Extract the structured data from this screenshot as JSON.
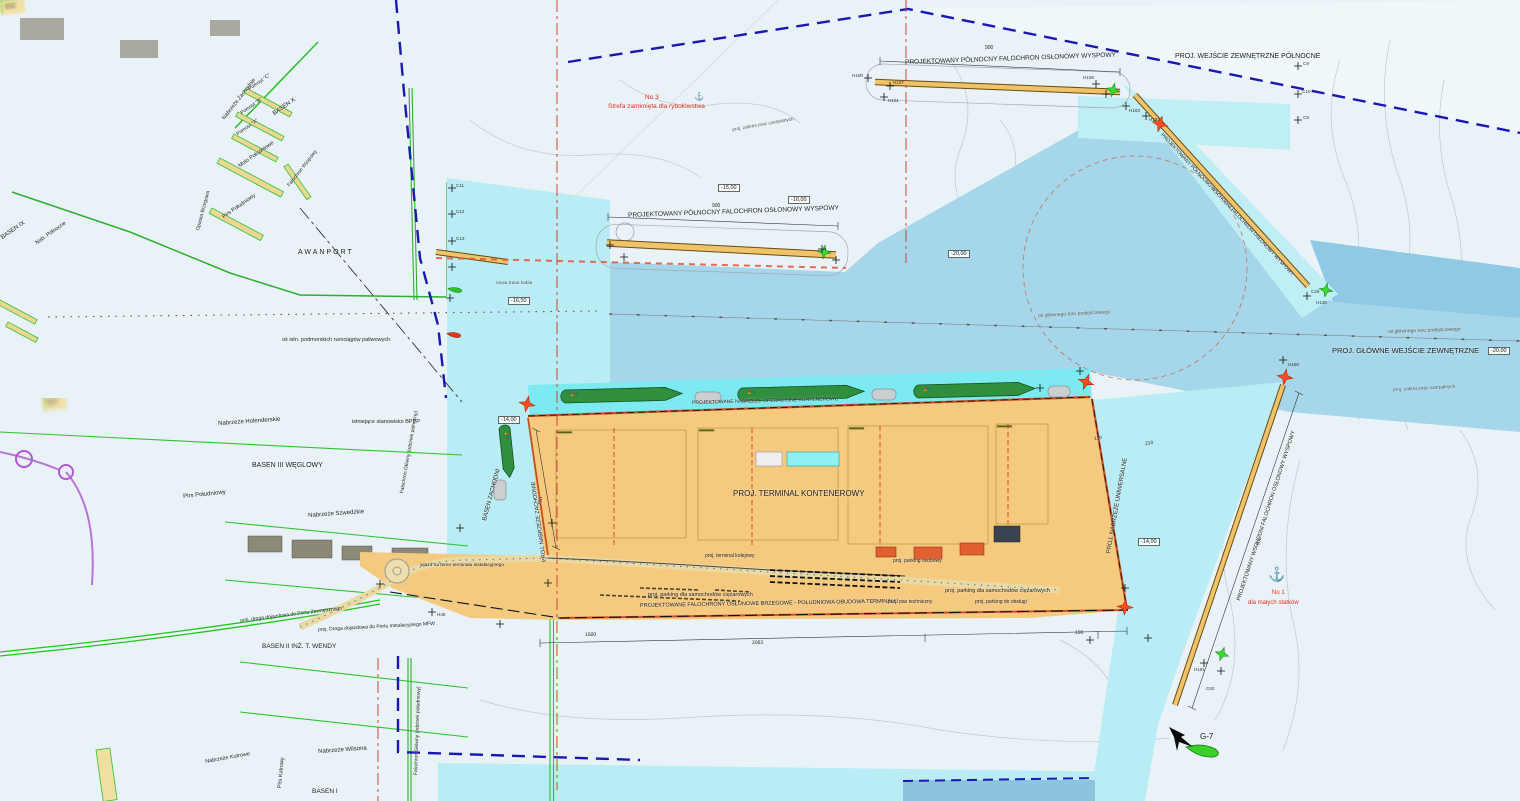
{
  "map": {
    "labels": {
      "entrance_north": "PROJ. WEJŚCIE ZEWNĘTRZNE PÓŁNOCNE",
      "entrance_main": "PROJ. GŁÓWNE WEJŚCIE ZEWNĘTRZNE",
      "bw_island_north": "PROJEKTOWANY PÓŁNOCNY FALOCHRON OSŁONOWY WYSPOWY",
      "bw_east": "PROJEKTOWANY WSCHODNI FALOCHRON OSŁONOWY WYSPOWY",
      "bw_northeast": "PROJEKTOWANY PÓŁNOCNO-WSCHODNI FALOCHRON OSŁONOWY WYSPOWY",
      "bw_shore_south": "PROJEKTOWANE FALOCHRONY OSŁONOWE BRZEGOWE - POŁUDNIOWA OBUDOWA TERMINALU",
      "terminal": "PROJ. TERMINAL KONTENEROWY",
      "quay_container": "PROJEKTOWANE NABRZEŻE OPERACYJNE KONTENEROWE",
      "quay_universal": "PROJ. NABRZEŻE UNIWERSALNE",
      "quay_west": "PROJ. NABRZEŻE ZACHODNIE",
      "basin_west": "BASEN ZACHODNI",
      "axis_channel": "oś głównego toru podejściowego",
      "axis_pipelines": "oś istn. podmorskich rurociągów paliwowych",
      "dredging": "proj. zakres prac czerpalnych",
      "cable": "nowa trasa kabla",
      "fishing_no3": "No 3",
      "fishing_zone": "Strefa zamknięta dla rybołówstwa",
      "anchorage_no1": "No 1",
      "anchorage_small": "dla małych statków",
      "awanport": "AWANPORT",
      "basen_3": "BASEN III  WĘGLOWY",
      "basen_2": "BASEN II  INŻ. T. WENDY",
      "basen_1": "BASEN I",
      "basen_9": "BASEN IX",
      "basen_10": "BASEN X",
      "nab_holenderskie": "Nabrzeże Holenderskie",
      "nab_szwedzkie": "Nabrzeże Szwedzkie",
      "nab_wilsona": "Nabrzeże Wilsona",
      "nab_kutrowe": "Nabrzeże Kutrowe",
      "nab_zachodnie": "Nabrzeże Zachodnie",
      "nab_polnocne": "Nab. Północne",
      "pirs_poludniowy": "Pirs Południowy",
      "pirs_kutrowy": "Pirs Kutrowy",
      "molo_poludniowe": "Molo Południowe",
      "falochron_wyspowy": "Falochron Wyspowy",
      "falochron_n": "Falochron Główny (odcinek północny)",
      "falochron_s": "Falochron Główny (odcinek południowy)",
      "opaska": "Opaska Brzegowa",
      "pomost_a": "Pomost \"A\"",
      "pomost_b": "Pomost \"B\"",
      "pomost_c": "Pomost \"C\"",
      "bppp": "istniejące stanowisko BPPP",
      "road_outer": "proj. droga dojazdowa do Portu Zewnętrznego",
      "road_mfw": "proj. Droga dojazdowa do Portu Instalacyjnego MFW",
      "gate": "wjazd na teren terminalu instalacyjnego",
      "parking_trucks": "proj. parking dla samochodów ciężarowych",
      "parking_cars": "proj. parking osobowy",
      "parking_service": "proj. parking do obsługi",
      "tech_strip": "proj. pas techniczny",
      "rail_terminal": "proj. terminal kolejowy",
      "g7": "G-7"
    },
    "depths": {
      "d15": "-15,00",
      "d16": "-16,00",
      "d1650": "-16,50",
      "d20": "-20,00",
      "d14": "-14,00"
    },
    "dimensions": {
      "d900": "900",
      "d700": "700",
      "d110": "110",
      "d210": "210",
      "d1500": "1500",
      "d2063": "2063",
      "d190": "190"
    },
    "markers": {
      "h100": "H100",
      "h101": "H101",
      "h103": "H103",
      "h106": "H106",
      "h107": "H107",
      "h152": "H152",
      "h150": "H150",
      "h130": "H130",
      "h181": "H181",
      "h45": "H45",
      "c8": "C8",
      "c9": "C9",
      "c10": "C10",
      "c11": "C11",
      "c12": "C12",
      "c13": "C13",
      "c26": "C26",
      "c62": "C62"
    },
    "symbols": {
      "anchor": "⚓"
    },
    "colors": {
      "water_shallow": "#e9f3f7",
      "water_project": "#b9ecf4",
      "water_channel": "#a6d6ea",
      "water_deep": "#8fc9e3",
      "water_berth": "#7de9f0",
      "land": "#f2dfa2",
      "terminal": "#f6c87d",
      "breakwater": "#eec36a",
      "boundary": "#1a18b0",
      "axis_red": "#cc4433",
      "green_line": "#22c51f",
      "nav_red": "#ff4a1f",
      "nav_green": "#35dd2e"
    }
  }
}
